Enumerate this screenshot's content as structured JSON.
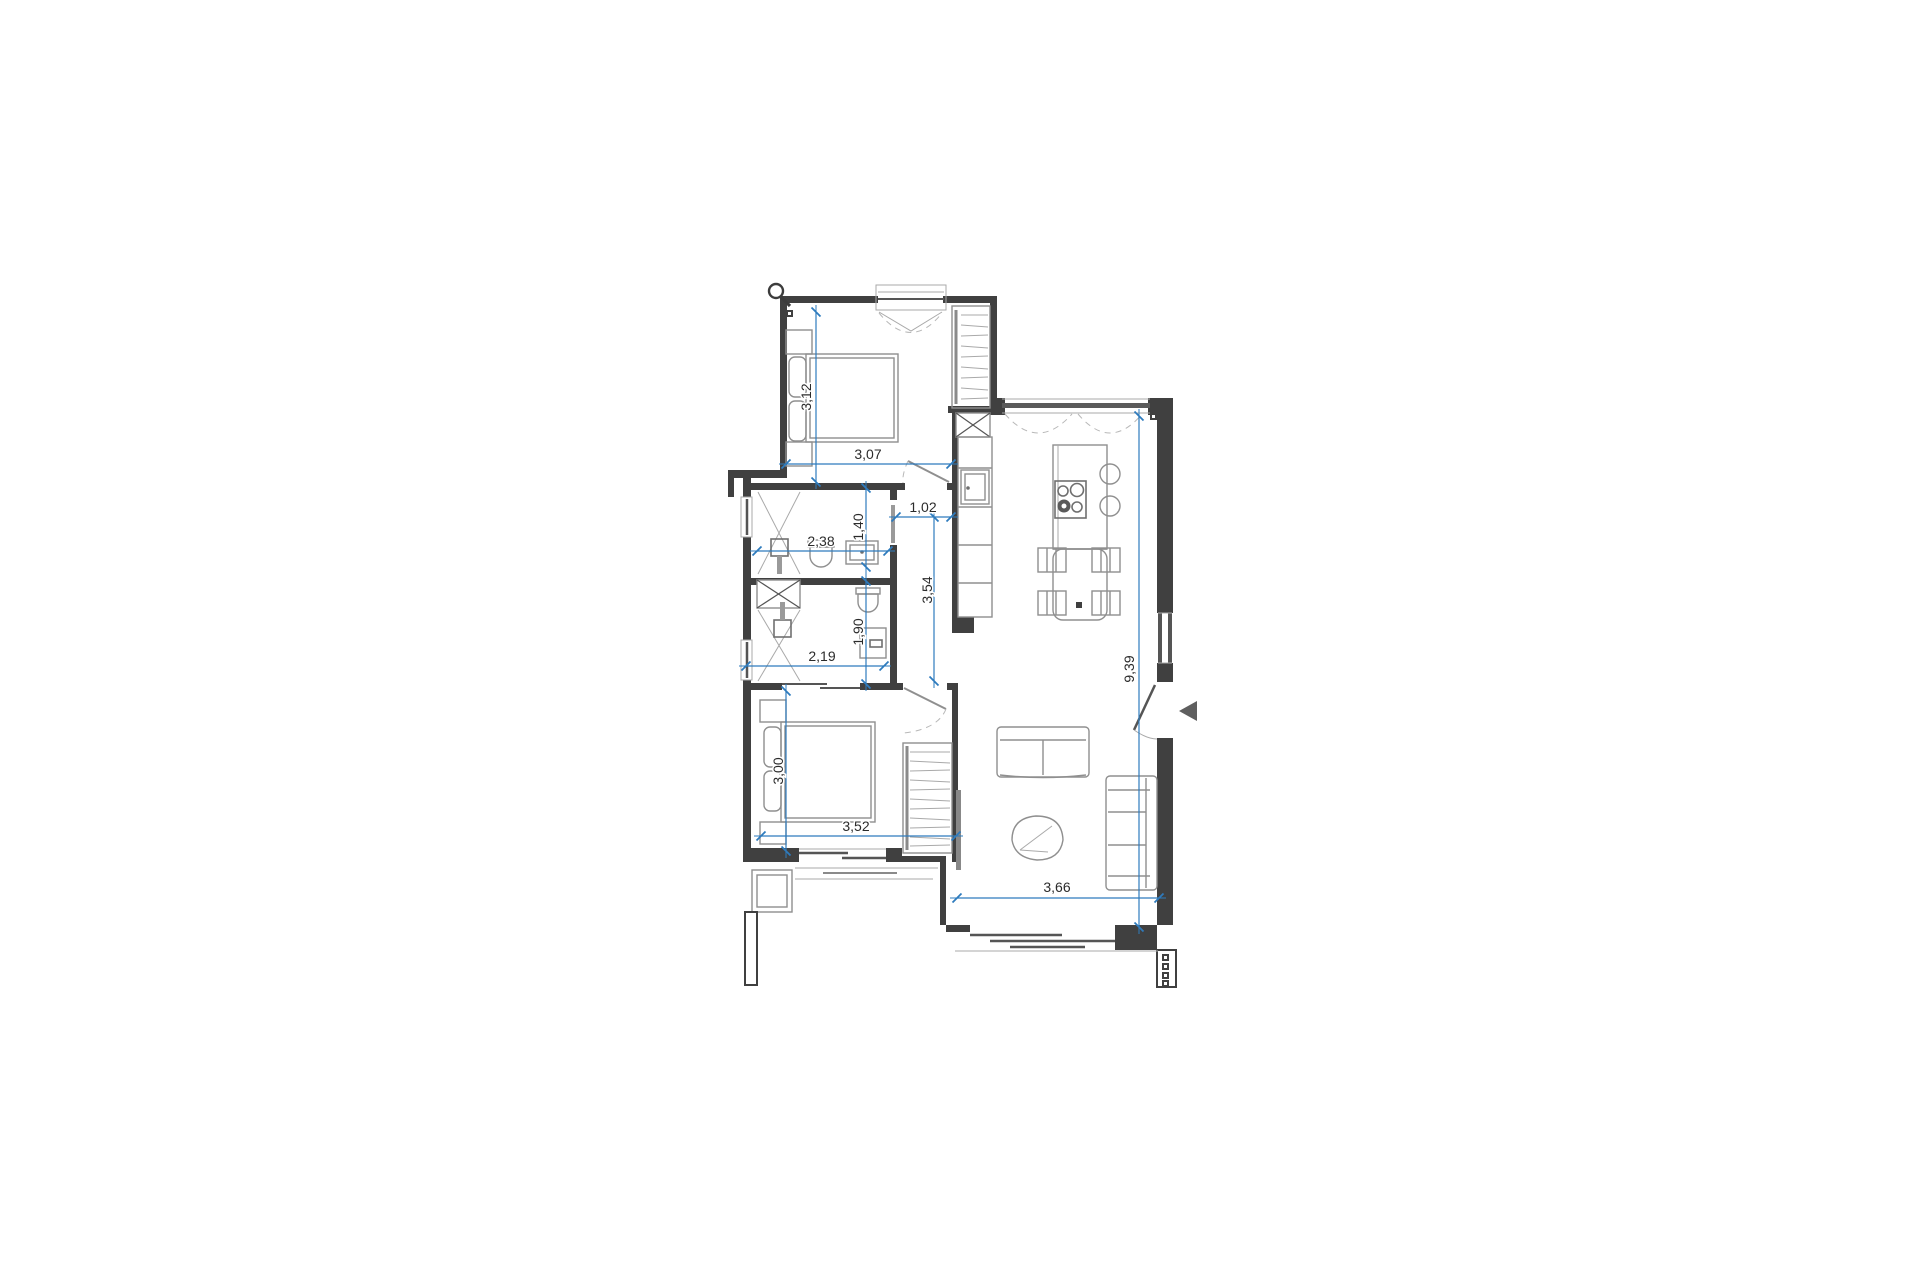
{
  "drawing": {
    "background": "#ffffff",
    "palette": {
      "wall": "#404040",
      "furniture_line": "#8f8f8f",
      "dimension_blue": "#2e7bbd",
      "label_text": "#2b2b2b"
    },
    "icons": {
      "magnifier": "magnifier-icon",
      "entrance_arrow": "entrance-arrow-icon"
    },
    "dimensions": {
      "bed1_depth": {
        "value": "3,12",
        "orientation": "vertical"
      },
      "bed1_width": {
        "value": "3,07",
        "orientation": "horizontal"
      },
      "hall_width": {
        "value": "1,02",
        "orientation": "horizontal"
      },
      "hall_length": {
        "value": "3,54",
        "orientation": "vertical"
      },
      "bath1_depth": {
        "value": "1,40",
        "orientation": "vertical"
      },
      "bath1_width": {
        "value": "2,38",
        "orientation": "horizontal"
      },
      "bath2_width": {
        "value": "2,19",
        "orientation": "horizontal"
      },
      "bath2_depth": {
        "value": "1,90",
        "orientation": "vertical"
      },
      "bed2_depth": {
        "value": "3,00",
        "orientation": "vertical"
      },
      "bed2_width": {
        "value": "3,52",
        "orientation": "horizontal"
      },
      "living_length": {
        "value": "9,39",
        "orientation": "vertical"
      },
      "living_width": {
        "value": "3,66",
        "orientation": "horizontal"
      }
    }
  }
}
